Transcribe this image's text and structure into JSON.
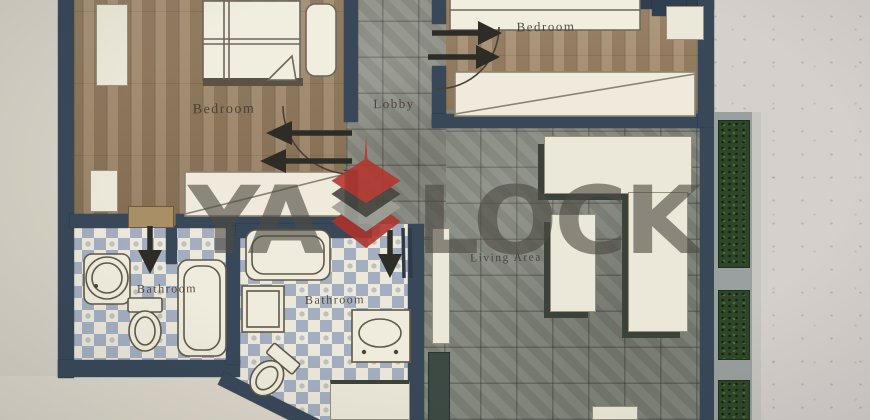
{
  "watermark": {
    "prefix": "YA",
    "suffix": "LOCK",
    "logo": "stacked-diamond-spire-logo",
    "logo_red": "#b5352e",
    "text_gray": "#4e4a42"
  },
  "rooms": {
    "bedroom_left": "Bedroom",
    "bedroom_top_right": "Bedroom",
    "lobby": "Lobby",
    "bathroom_left": "Bathroom",
    "bathroom_center": "Bathroom",
    "living_area": "Living Area"
  },
  "icons": {
    "door_arrow": "direction-arrow",
    "door_swing": "door-swing-arc",
    "bed": "bed",
    "wardrobe": "wardrobe-crossed",
    "toilet": "toilet",
    "bathtub": "bathtub",
    "shower": "shower-tray",
    "sink": "sink",
    "hedge": "balcony-hedge"
  },
  "colors": {
    "wall": "#37485a",
    "wood_floor": "#988062",
    "stone_floor": "#81857a",
    "bathroom_tile_accent": "#a3afc2",
    "furniture": "#ece8d8",
    "planter_green": "#2d4727",
    "paper": "#d6d0cc"
  }
}
